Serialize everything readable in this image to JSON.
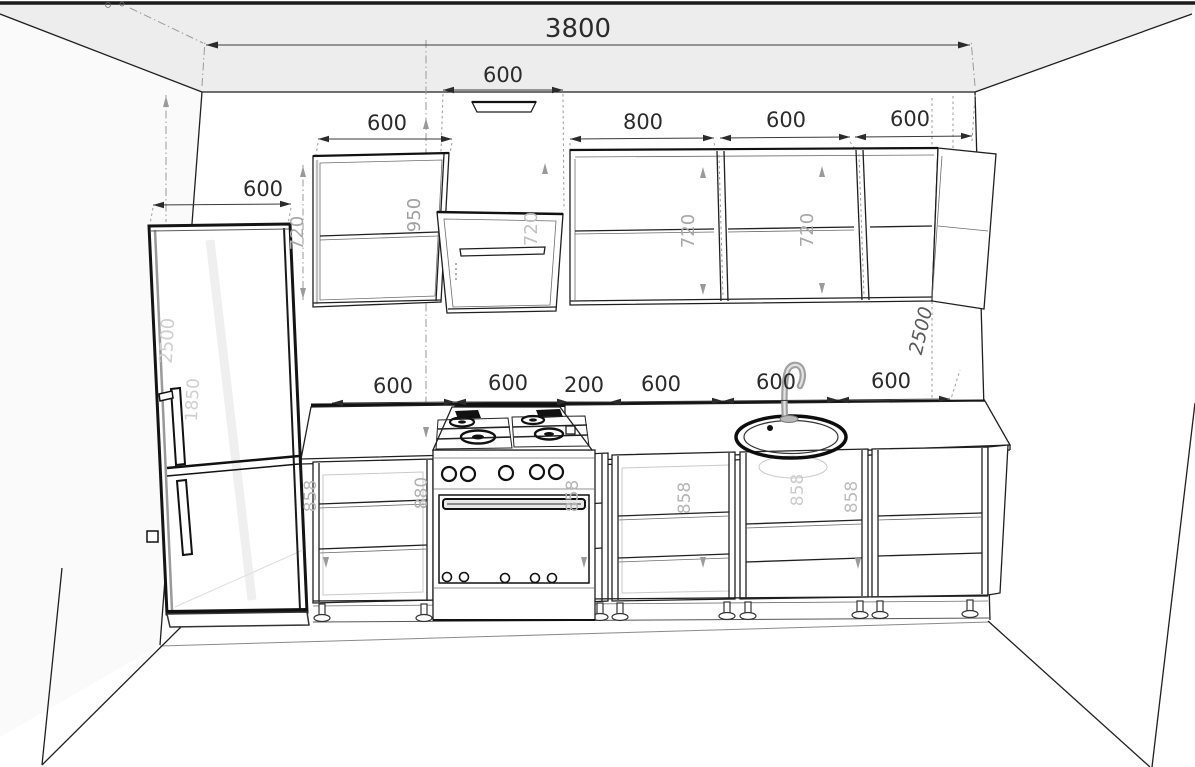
{
  "dims": {
    "total_width": "3800",
    "hood_width": "600",
    "fridge_width": "600",
    "upper_row": [
      "600",
      "800",
      "600",
      "600"
    ],
    "base_row": [
      "600",
      "600",
      "200",
      "600",
      "600",
      "600"
    ],
    "upper_heights": [
      "720",
      "950",
      "720",
      "720",
      "720"
    ],
    "base_heights": [
      "858",
      "880",
      "858",
      "858",
      "858",
      "858"
    ],
    "fridge_height": "1850",
    "wall_height_left": "2500",
    "wall_height_right": "2500"
  },
  "style": {
    "line_color": "#1f1f1f",
    "dim_text_color": "#2b2b2b",
    "hidden_dim_color": "#bdbdbd",
    "background": "#ffffff"
  }
}
